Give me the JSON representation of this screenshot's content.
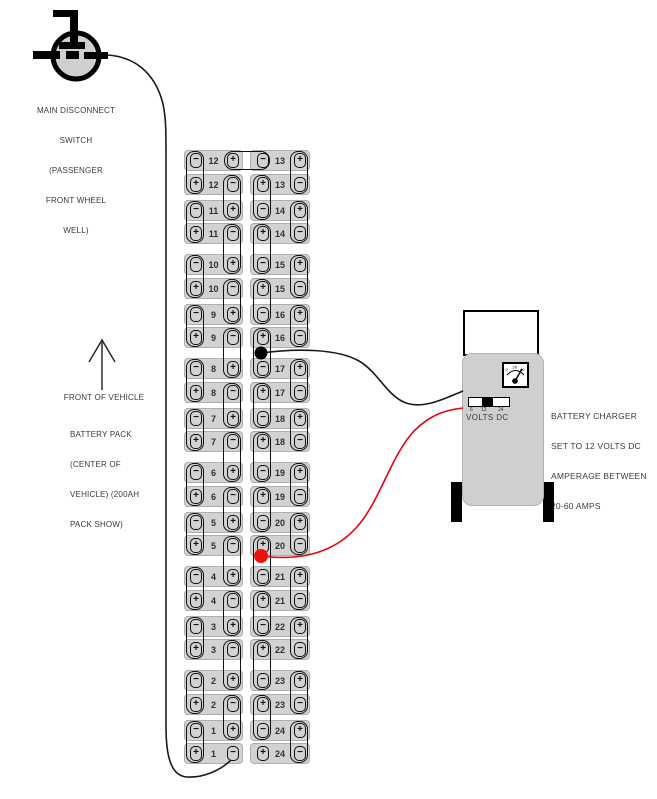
{
  "colors": {
    "battery_fill": "#d2d2d2",
    "charger_body": "#cfcfcf",
    "wire_black": "#1a1a1a",
    "wire_red": "#e8000b",
    "tap_dot_black": "#000000",
    "tap_dot_red": "#ee1111"
  },
  "disconnect_switch": {
    "label_lines": [
      "MAIN DISCONNECT",
      "SWITCH",
      "(PASSENGER",
      "FRONT WHEEL",
      "WELL)"
    ]
  },
  "front_arrow": {
    "label": "FRONT OF VEHICLE"
  },
  "battery_pack": {
    "label_lines": [
      "BATTERY PACK",
      "(CENTER OF",
      "VEHICLE) (200AH",
      "PACK SHOW)"
    ],
    "left_column_rows": [
      [
        "12",
        "−",
        "+"
      ],
      [
        "12",
        "+",
        "−"
      ],
      [
        "11",
        "−",
        "+"
      ],
      [
        "11",
        "+",
        "−"
      ],
      [
        "10",
        "−",
        "+"
      ],
      [
        "10",
        "+",
        "−"
      ],
      [
        "9",
        "−",
        "+"
      ],
      [
        "9",
        "+",
        "−"
      ],
      [
        "8",
        "−",
        "+"
      ],
      [
        "8",
        "+",
        "−"
      ],
      [
        "7",
        "−",
        "+"
      ],
      [
        "7",
        "+",
        "−"
      ],
      [
        "6",
        "−",
        "+"
      ],
      [
        "6",
        "+",
        "−"
      ],
      [
        "5",
        "−",
        "+"
      ],
      [
        "5",
        "+",
        "−"
      ],
      [
        "4",
        "−",
        "+"
      ],
      [
        "4",
        "+",
        "−"
      ],
      [
        "3",
        "−",
        "+"
      ],
      [
        "3",
        "+",
        "−"
      ],
      [
        "2",
        "−",
        "+"
      ],
      [
        "2",
        "+",
        "−"
      ],
      [
        "1",
        "−",
        "+"
      ],
      [
        "1",
        "+",
        "−"
      ]
    ],
    "right_column_rows": [
      [
        "13",
        "−",
        "+"
      ],
      [
        "13",
        "+",
        "−"
      ],
      [
        "14",
        "−",
        "+"
      ],
      [
        "14",
        "+",
        "−"
      ],
      [
        "15",
        "−",
        "+"
      ],
      [
        "15",
        "+",
        "−"
      ],
      [
        "16",
        "−",
        "+"
      ],
      [
        "16",
        "+",
        "−"
      ],
      [
        "17",
        "−",
        "+"
      ],
      [
        "17",
        "+",
        "−"
      ],
      [
        "18",
        "−",
        "+"
      ],
      [
        "18",
        "+",
        "−"
      ],
      [
        "19",
        "−",
        "+"
      ],
      [
        "19",
        "+",
        "−"
      ],
      [
        "20",
        "−",
        "+"
      ],
      [
        "20",
        "+",
        "−"
      ],
      [
        "21",
        "−",
        "+"
      ],
      [
        "21",
        "+",
        "−"
      ],
      [
        "22",
        "−",
        "+"
      ],
      [
        "22",
        "+",
        "−"
      ],
      [
        "23",
        "−",
        "+"
      ],
      [
        "23",
        "+",
        "−"
      ],
      [
        "24",
        "−",
        "+"
      ],
      [
        "24",
        "+",
        "−"
      ]
    ]
  },
  "charger": {
    "label_lines": [
      "BATTERY CHARGER",
      "SET TO 12 VOLTS DC",
      "AMPERAGE BETWEEN",
      "20-60 AMPS"
    ],
    "meter_scale": [
      "0",
      "20",
      "40"
    ],
    "volts_scale": [
      "6",
      "12",
      "24"
    ],
    "volts_label": "VOLTS DC"
  }
}
